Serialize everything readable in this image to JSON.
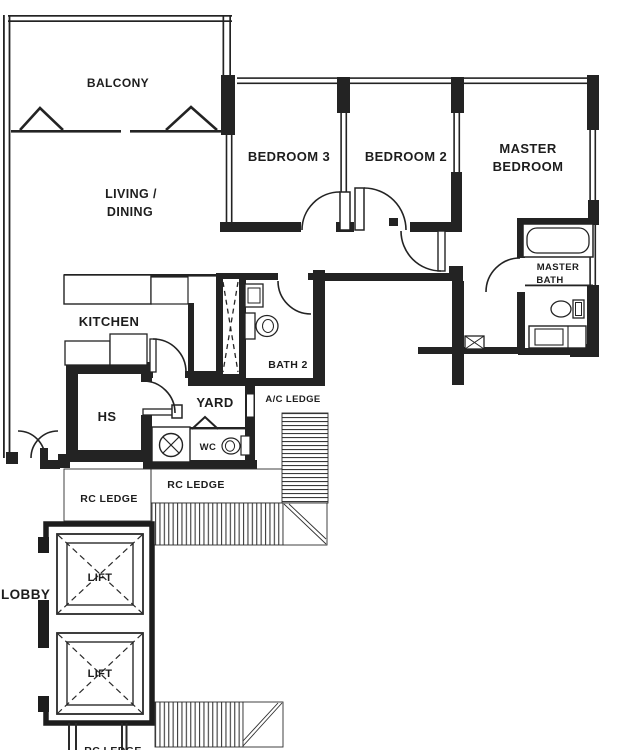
{
  "floor_plan": {
    "rooms": {
      "balcony": "BALCONY",
      "living_line1": "LIVING /",
      "living_line2": "DINING",
      "bedroom3": "BEDROOM 3",
      "bedroom2": "BEDROOM 2",
      "master_bedroom_line1": "MASTER",
      "master_bedroom_line2": "BEDROOM",
      "master_bath_line1": "MASTER",
      "master_bath_line2": "BATH",
      "bath2": "BATH 2",
      "kitchen": "KITCHEN",
      "household_shelter": "HS",
      "yard": "YARD",
      "wc": "WC",
      "ac_ledge": "A/C LEDGE",
      "rc_ledge_left": "RC LEDGE",
      "rc_ledge_right": "RC LEDGE",
      "rc_ledge_bottom_partial": "RC LEDGE",
      "lobby": "LOBBY",
      "lift_1": "LIFT",
      "lift_2": "LIFT"
    },
    "colors": {
      "ink": "#1f1f1f",
      "paper": "#ffffff"
    }
  }
}
